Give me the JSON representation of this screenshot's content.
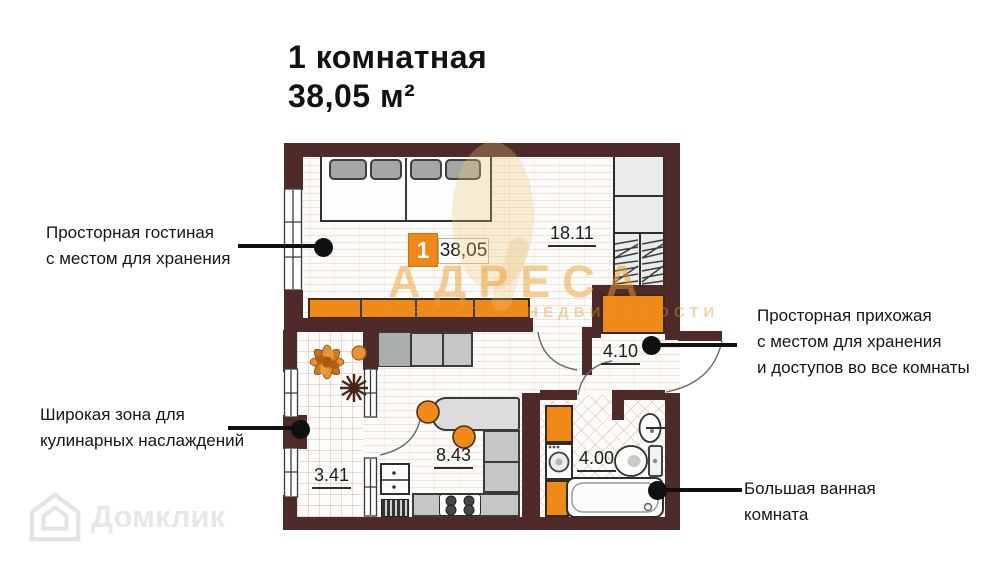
{
  "page_title": {
    "line1": "1 комнатная",
    "line2": "38,05 м²"
  },
  "badge": {
    "room_number": "1",
    "area": "38,05"
  },
  "rooms": {
    "living": {
      "area": "18.11"
    },
    "hallway": {
      "area": "4.10"
    },
    "kitchen": {
      "area": "8.43"
    },
    "balcony": {
      "area": "3.41"
    },
    "bathroom": {
      "area": "4.00"
    }
  },
  "callouts": {
    "living": {
      "line1": "Просторная гостиная",
      "line2": "с местом для хранения"
    },
    "kitchen": {
      "line1": "Широкая зона для",
      "line2": "кулинарных наслаждений"
    },
    "hallway": {
      "line1": "Просторная прихожая",
      "line2": "с местом для хранения",
      "line3": "и доступов во все комнаты"
    },
    "bathroom": {
      "line1": "Большая ванная",
      "line2": "комната"
    }
  },
  "watermarks": {
    "agency_name": "АДРЕСА",
    "agency_subtitle": "АГЕНТСТВО НЕДВИЖИМОСТИ",
    "portal_name": "Домклик"
  },
  "colors": {
    "wall": "#4e2a28",
    "accent_orange": "#ef8a18",
    "callout": "#101010"
  }
}
